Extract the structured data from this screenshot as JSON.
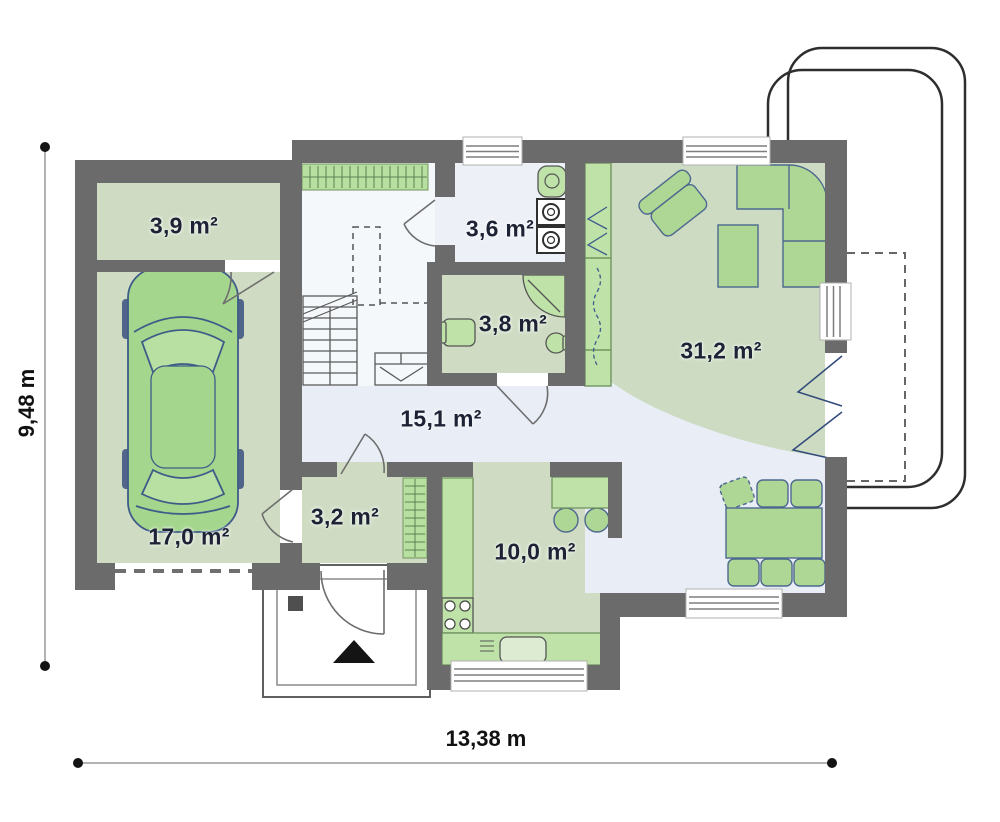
{
  "plan": {
    "dimension_width_label": "13,38 m",
    "dimension_height_label": "9,48 m"
  },
  "rooms": [
    {
      "id": "storage",
      "area_label": "3,9 m²"
    },
    {
      "id": "utility-room",
      "area_label": "3,6 m²"
    },
    {
      "id": "bathroom",
      "area_label": "3,8 m²"
    },
    {
      "id": "living-room",
      "area_label": "31,2 m²"
    },
    {
      "id": "hall",
      "area_label": "15,1 m²"
    },
    {
      "id": "garage",
      "area_label": "17,0 m²"
    },
    {
      "id": "vestibule",
      "area_label": "3,2 m²"
    },
    {
      "id": "kitchen",
      "area_label": "10,0 m²"
    }
  ],
  "colors": {
    "wall": "#6b6b6b",
    "room_fill": "#cfdcc3",
    "floor_light": "#e9eef6",
    "furniture_fill": "#aed795",
    "furniture_fill_light": "#bfe2a9",
    "furniture_stroke": "#4d688f",
    "label_text": "#1d2335"
  }
}
